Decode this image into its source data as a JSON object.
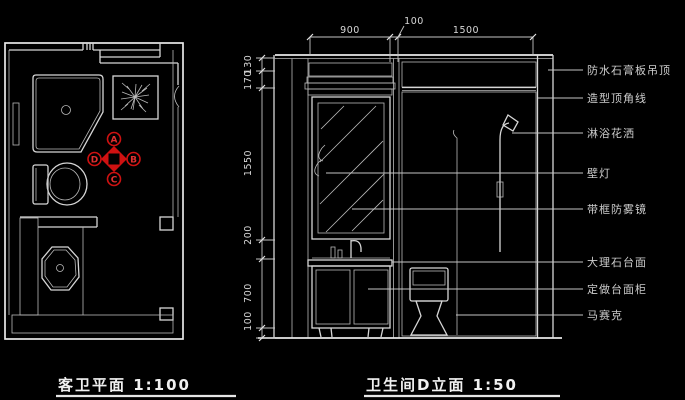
{
  "floor_plan": {
    "caption": "客卫平面 1:100",
    "elevation_marker": {
      "top": "A",
      "right": "B",
      "bottom": "C",
      "left": "D"
    }
  },
  "elevation": {
    "caption": "卫生间D立面 1:50",
    "dims_top": [
      "900",
      "100",
      "1500"
    ],
    "dims_left": [
      "130",
      "170",
      "1550",
      "200",
      "700",
      "100"
    ],
    "labels": [
      "防水石膏板吊顶",
      "造型顶角线",
      "淋浴花洒",
      "壁灯",
      "带框防雾镜",
      "大理石台面",
      "定做台面柜",
      "马赛克"
    ]
  },
  "colors": {
    "background": "#000000",
    "line": "#d6d6d6",
    "marker_red": "#cf1111"
  }
}
